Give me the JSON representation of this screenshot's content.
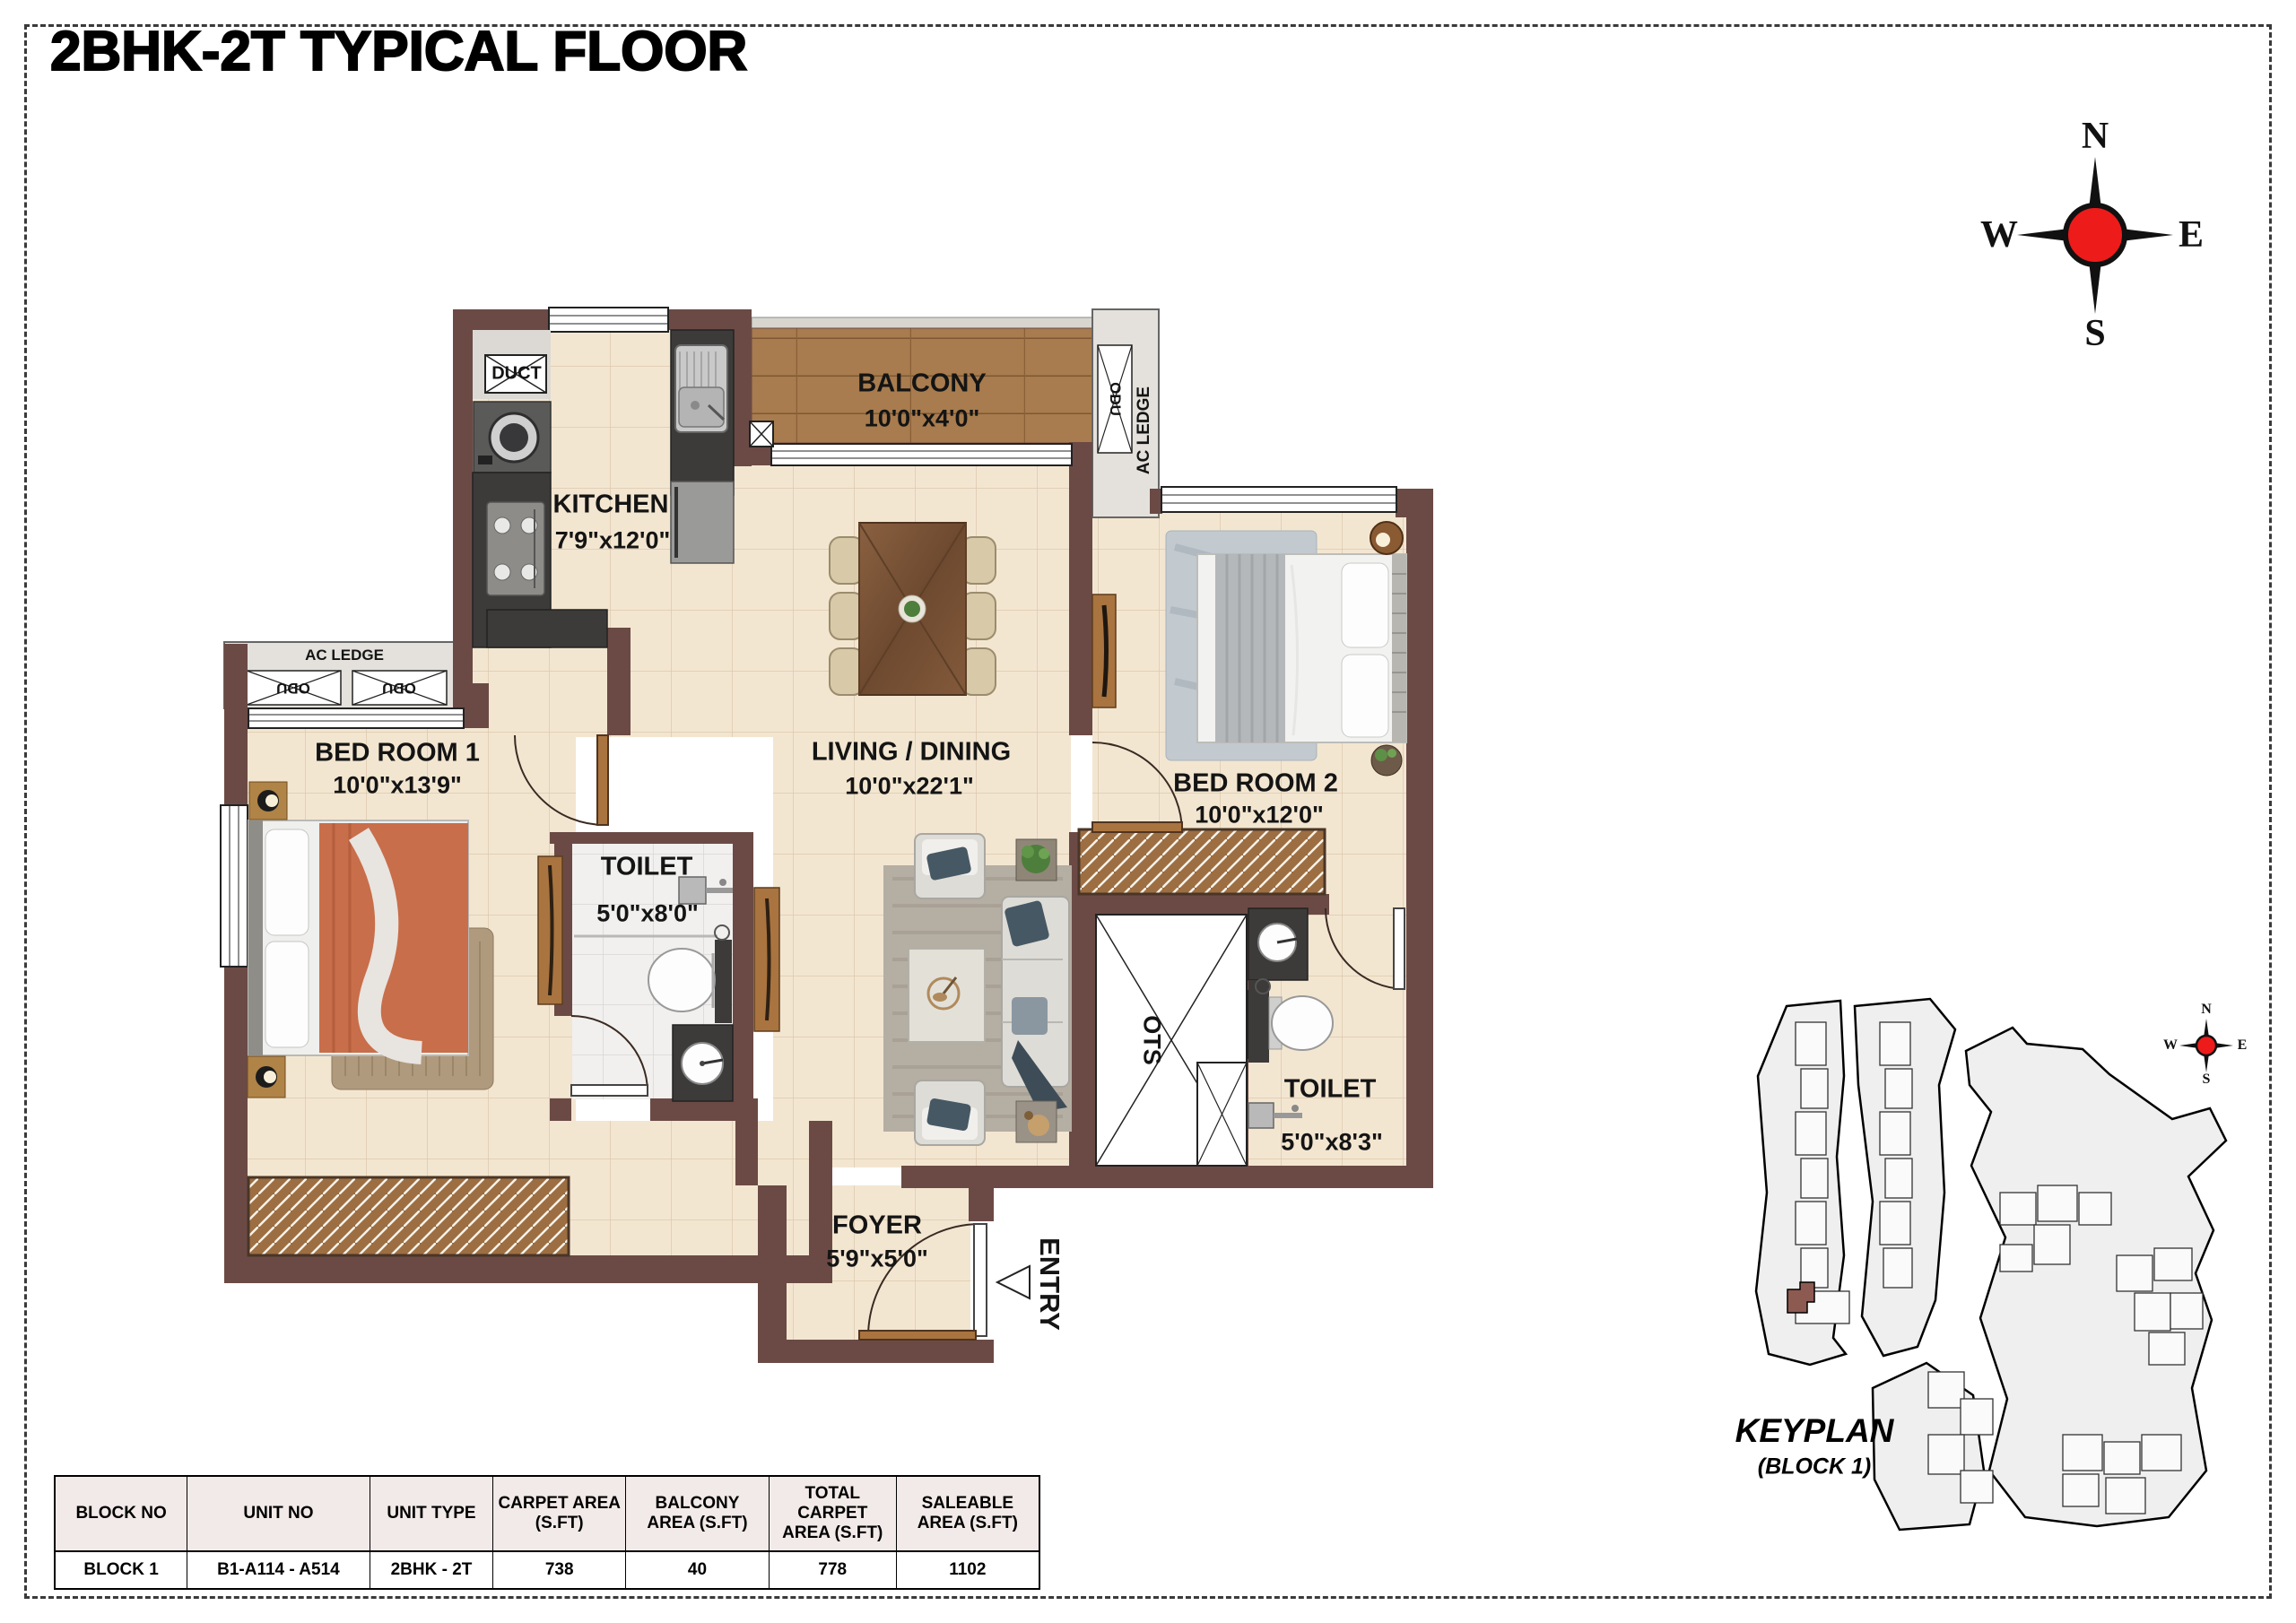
{
  "title": "2BHK-2T TYPICAL FLOOR",
  "compass": {
    "n": "N",
    "e": "E",
    "s": "S",
    "w": "W"
  },
  "rooms": {
    "balcony": {
      "name": "BALCONY",
      "dims": "10'0\"x4'0\""
    },
    "kitchen": {
      "name": "KITCHEN",
      "dims": "7'9\"x12'0\""
    },
    "living": {
      "name": "LIVING / DINING",
      "dims": "10'0\"x22'1\""
    },
    "bedroom1": {
      "name": "BED ROOM 1",
      "dims": "10'0\"x13'9\""
    },
    "bedroom2": {
      "name": "BED ROOM 2",
      "dims": "10'0\"x12'0\""
    },
    "toilet1": {
      "name": "TOILET",
      "dims": "5'0\"x8'0\""
    },
    "toilet2": {
      "name": "TOILET",
      "dims": "5'0\"x8'3\""
    },
    "foyer": {
      "name": "FOYER",
      "dims": "5'9\"x5'0\""
    }
  },
  "annotations": {
    "duct": "DUCT",
    "odu": "ODU",
    "ac_ledge": "AC LEDGE",
    "ots": "OTS",
    "entry": "ENTRY"
  },
  "keyplan": {
    "title": "KEYPLAN",
    "subtitle": "(BLOCK 1)"
  },
  "area_table": {
    "headers": [
      "BLOCK NO",
      "UNIT NO",
      "UNIT TYPE",
      "CARPET AREA (S.FT)",
      "BALCONY AREA (S.FT)",
      "TOTAL CARPET AREA (S.FT)",
      "SALEABLE AREA (S.FT)"
    ],
    "row": [
      "BLOCK 1",
      "B1-A114 - A514",
      "2BHK - 2T",
      "738",
      "40",
      "778",
      "1102"
    ]
  },
  "colors": {
    "wall": "#6b4a45",
    "floor": "#f3e6d1",
    "balcony_wood": "#a87c4e",
    "granite": "#3c3b39",
    "ledge": "#e4e1dc",
    "compass_red": "#ee1b1b",
    "highlight_unit": "#8d5a52"
  }
}
